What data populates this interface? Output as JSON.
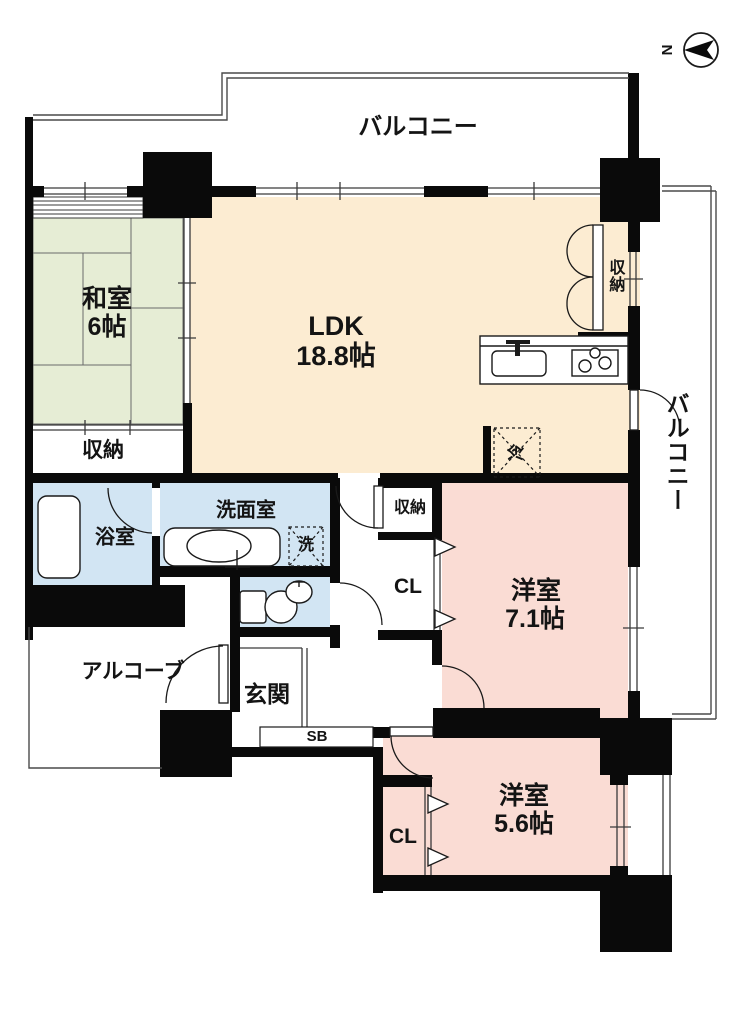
{
  "compass": {
    "north_label": "N"
  },
  "balcony_top": {
    "label": "バルコニー"
  },
  "balcony_right": {
    "label": "バルコニー"
  },
  "rooms": {
    "washitsu": {
      "name": "和室",
      "area": "6帖"
    },
    "ldk": {
      "name": "LDK",
      "area": "18.8帖"
    },
    "western_room_1": {
      "name": "洋室",
      "area": "7.1帖"
    },
    "western_room_2": {
      "name": "洋室",
      "area": "5.6帖"
    },
    "washroom": {
      "name": "洗面室"
    },
    "bathroom": {
      "name": "浴室"
    },
    "entrance": {
      "name": "玄関"
    },
    "alcove": {
      "name": "アルコーブ"
    }
  },
  "storages": {
    "washitsu_closet": "収納",
    "ldk_closet": "収納",
    "hall_closet": "収納",
    "closet_1": "CL",
    "closet_2": "CL",
    "shoe_box": "SB"
  },
  "appliances": {
    "refrigerator": "冷",
    "washing_machine": "洗"
  },
  "colors": {
    "tatami": "#e6edd5",
    "ldk": "#fcecd2",
    "western": "#fadcd4",
    "wet": "#d2e5f3",
    "wall": "#0a0a0a",
    "line": "#3a3a3a"
  }
}
